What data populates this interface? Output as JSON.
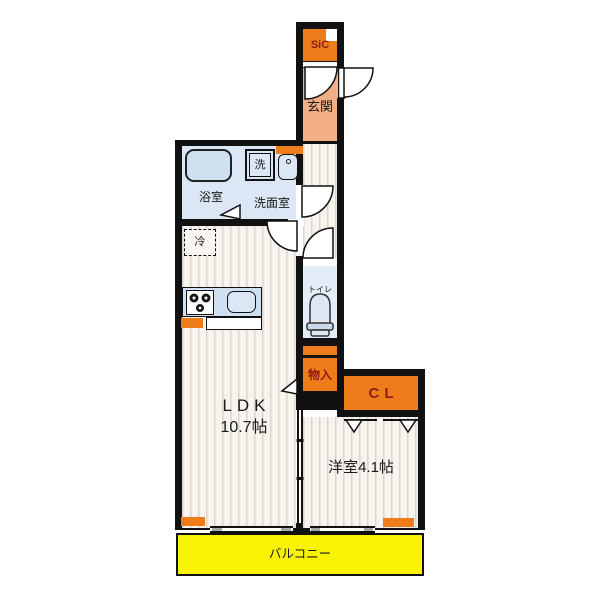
{
  "title": "1LDK apartment floor plan",
  "colors": {
    "wall": "#111111",
    "orange": "#ef7c1a",
    "accent_text": "#8c1c1c",
    "genkan": "#f2ae85",
    "bath_bg": "#dbe7f4",
    "fixture": "#cfe0f0",
    "toilet_bg": "#e3edf8",
    "floor": "#f7f3ee",
    "stripe": "#ddd5ca",
    "balcony": "#f7f303",
    "window_gray": "#a8a8a8",
    "label": "#1a1a1a"
  },
  "labels": {
    "sic": "SiC",
    "genkan": "玄関",
    "bath": "浴室",
    "washer": "洗",
    "washroom": "洗面室",
    "fridge": "冷",
    "toilet": "トイレ",
    "storage": "物入",
    "closet": "CL",
    "ldk": "LDK",
    "ldk_size": "10.7帖",
    "western_room": "洋室4.1帖",
    "balcony": "バルコニー"
  }
}
